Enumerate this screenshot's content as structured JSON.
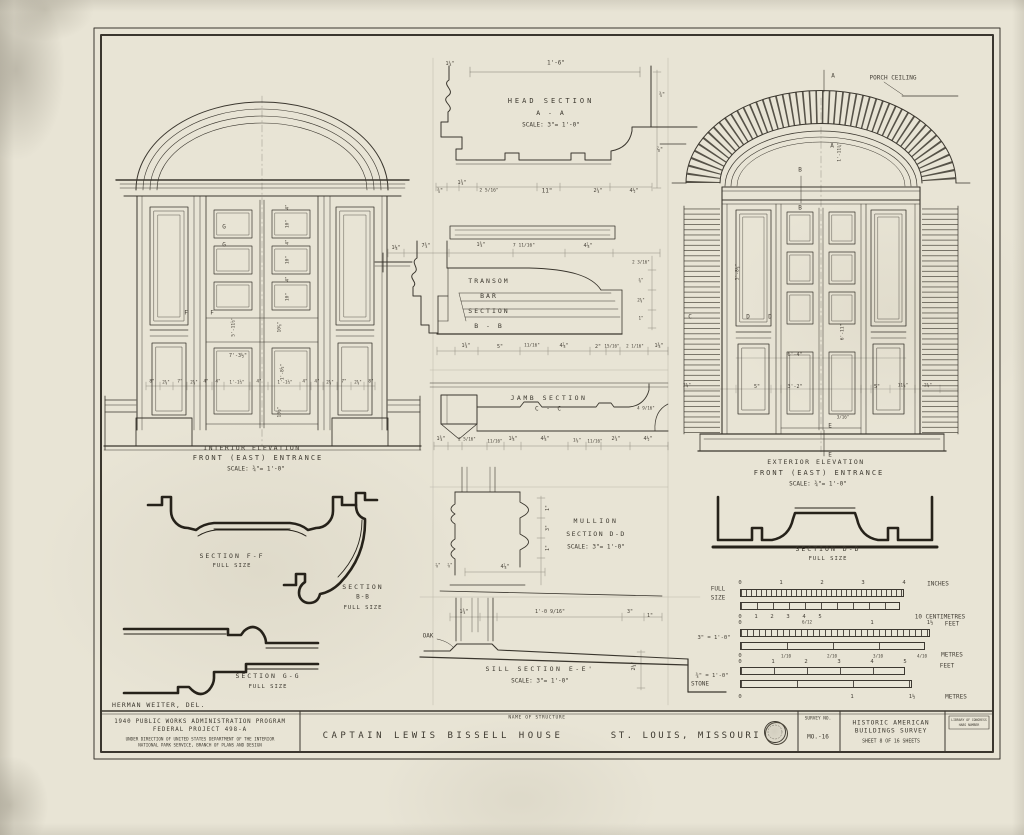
{
  "colors": {
    "paper": "#e8e4d5",
    "ink": "#3a362e",
    "heavy": "#26221a"
  },
  "titles": {
    "interior": {
      "l1": "INTERIOR ELEVATION",
      "l2": "FRONT (EAST) ENTRANCE",
      "scale": "SCALE:   ¾\"= 1'-0\""
    },
    "exterior": {
      "l1": "EXTERIOR ELEVATION",
      "l2": "FRONT (EAST) ENTRANCE",
      "scale": "SCALE:   ¾\"= 1'-0\""
    },
    "head": {
      "l1": "HEAD SECTION",
      "l2": "A - A",
      "scale": "SCALE:   3\"= 1'-0\""
    },
    "transom": {
      "l1": "TRANSOM",
      "l2": "BAR",
      "l3": "SECTION",
      "l4": "B - B"
    },
    "jamb": {
      "l1": "JAMB SECTION",
      "l2": "C - C"
    },
    "mullion": {
      "l1": "MULLION",
      "l2": "SECTION D-D",
      "scale": "SCALE: 3\"= 1'-0\""
    },
    "sill": {
      "l1": "SILL SECTION E-E'",
      "scale": "SCALE:  3\"= 1'-0\""
    },
    "ff": {
      "l1": "SECTION F-F",
      "l2": "FULL SIZE"
    },
    "bb": {
      "l1": "SECTION",
      "l2": "B-B",
      "l3": "FULL SIZE"
    },
    "gg": {
      "l1": "SECTION G-G",
      "l2": "FULL SIZE"
    },
    "dd": {
      "l1": "SECTION D-D",
      "l2": "FULL SIZE"
    },
    "delineator": "HERMAN WEITER, DEL."
  },
  "title_block": {
    "pwa1": "1940 PUBLIC WORKS ADMINISTRATION PROGRAM",
    "pwa2": "FEDERAL PROJECT 498-A",
    "pwa3": "UNDER DIRECTION OF UNITED STATES DEPARTMENT OF THE INTERIOR",
    "pwa4": "NATIONAL PARK SERVICE, BRANCH OF PLANS AND DESIGN",
    "name_label": "NAME OF STRUCTURE",
    "structure": "CAPTAIN LEWIS BISSELL HOUSE",
    "location": "ST. LOUIS, MISSOURI",
    "survey_label": "SURVEY NO.",
    "survey_no": "MO.-16",
    "habs1": "HISTORIC AMERICAN",
    "habs2": "BUILDINGS SURVEY",
    "habs3": "SHEET 8 OF 16 SHEETS",
    "loc1": "LIBRARY OF CONGRESS",
    "loc2": "HABS NUMBER"
  },
  "labels": [
    {
      "t": "1'-6\"",
      "x": 556,
      "y": 63
    },
    {
      "t": "1¼\"",
      "x": 450,
      "y": 64,
      "fs": 5
    },
    {
      "t": "¾\"",
      "x": 440,
      "y": 191,
      "fs": 5
    },
    {
      "t": "1¾\"",
      "x": 462,
      "y": 183,
      "fs": 5
    },
    {
      "t": "2 5/16\"",
      "x": 489,
      "y": 191,
      "fs": 4.6
    },
    {
      "t": "11\"",
      "x": 547,
      "y": 191
    },
    {
      "t": "2¼\"",
      "x": 598,
      "y": 191,
      "fs": 5
    },
    {
      "t": "4½\"",
      "x": 634,
      "y": 191,
      "fs": 5
    },
    {
      "t": "¾\"",
      "x": 662,
      "y": 95,
      "fs": 5
    },
    {
      "t": "⅞\"",
      "x": 660,
      "y": 150,
      "fs": 5
    },
    {
      "t": "1⅛\"",
      "x": 396,
      "y": 248,
      "fs": 5
    },
    {
      "t": "7¾\"",
      "x": 426,
      "y": 246,
      "fs": 5
    },
    {
      "t": "1¾\"",
      "x": 481,
      "y": 245,
      "fs": 5
    },
    {
      "t": "7 11/16\"",
      "x": 524,
      "y": 246,
      "fs": 4.6
    },
    {
      "t": "4⅞\"",
      "x": 588,
      "y": 246,
      "fs": 5
    },
    {
      "t": "1¾\"",
      "x": 466,
      "y": 346,
      "fs": 5
    },
    {
      "t": "5\"",
      "x": 500,
      "y": 347,
      "fs": 5
    },
    {
      "t": "11/16\"",
      "x": 532,
      "y": 346,
      "fs": 4.4
    },
    {
      "t": "4⅞\"",
      "x": 564,
      "y": 346,
      "fs": 5
    },
    {
      "t": "2\"",
      "x": 598,
      "y": 347,
      "fs": 5
    },
    {
      "t": "15/16\"",
      "x": 612,
      "y": 346,
      "fs": 4.2
    },
    {
      "t": "2 1/16\"",
      "x": 635,
      "y": 346,
      "fs": 4.2
    },
    {
      "t": "1⅜\"",
      "x": 659,
      "y": 346,
      "fs": 5
    },
    {
      "t": "2 3/16\"",
      "x": 641,
      "y": 262,
      "fs": 4.2
    },
    {
      "t": "⅜\"",
      "x": 641,
      "y": 280,
      "fs": 4.2
    },
    {
      "t": "2⅜\"",
      "x": 641,
      "y": 300,
      "fs": 4.2
    },
    {
      "t": "1\"",
      "x": 641,
      "y": 318,
      "fs": 4.2
    },
    {
      "t": "1¾\"",
      "x": 441,
      "y": 439,
      "fs": 5
    },
    {
      "t": "2 5/16\"",
      "x": 467,
      "y": 439,
      "fs": 4.2
    },
    {
      "t": "11/16\"",
      "x": 495,
      "y": 441,
      "fs": 4.2
    },
    {
      "t": "1⅛\"",
      "x": 513,
      "y": 439,
      "fs": 5
    },
    {
      "t": "4⅜\"",
      "x": 545,
      "y": 439,
      "fs": 5
    },
    {
      "t": "1⅛\"",
      "x": 577,
      "y": 441,
      "fs": 4.6
    },
    {
      "t": "11/16\"",
      "x": 595,
      "y": 441,
      "fs": 4.2
    },
    {
      "t": "2¼\"",
      "x": 616,
      "y": 439,
      "fs": 5
    },
    {
      "t": "4½\"",
      "x": 648,
      "y": 439,
      "fs": 5
    },
    {
      "t": "4 9/16\"",
      "x": 646,
      "y": 408,
      "fs": 4.2
    },
    {
      "t": "1\"",
      "x": 548,
      "y": 508,
      "r": -90,
      "fs": 5
    },
    {
      "t": "3\"",
      "x": 548,
      "y": 528,
      "r": -90,
      "fs": 5
    },
    {
      "t": "1\"",
      "x": 548,
      "y": 548,
      "r": -90,
      "fs": 5
    },
    {
      "t": "⅞\"",
      "x": 438,
      "y": 566,
      "fs": 4.4
    },
    {
      "t": "⅞\"",
      "x": 450,
      "y": 566,
      "fs": 4.4
    },
    {
      "t": "4⅞\"",
      "x": 505,
      "y": 567,
      "fs": 5
    },
    {
      "t": "1¾\"",
      "x": 464,
      "y": 612,
      "fs": 5
    },
    {
      "t": "1'-0 9/16\"",
      "x": 550,
      "y": 612,
      "fs": 5
    },
    {
      "t": "3\"",
      "x": 630,
      "y": 612,
      "fs": 5
    },
    {
      "t": "1\"",
      "x": 650,
      "y": 616,
      "fs": 5
    },
    {
      "t": "OAK",
      "x": 428,
      "y": 636,
      "fs": 6
    },
    {
      "t": "STONE",
      "x": 700,
      "y": 684,
      "fs": 6
    },
    {
      "t": "2¼\"",
      "x": 634,
      "y": 666,
      "r": -90,
      "fs": 5
    },
    {
      "t": "G",
      "x": 224,
      "y": 227,
      "fs": 6
    },
    {
      "t": "G",
      "x": 224,
      "y": 245,
      "fs": 6
    },
    {
      "t": "F",
      "x": 186,
      "y": 313,
      "fs": 6
    },
    {
      "t": "F",
      "x": 212,
      "y": 313,
      "fs": 6
    },
    {
      "t": "4\"",
      "x": 288,
      "y": 207,
      "r": -90,
      "fs": 4.6
    },
    {
      "t": "10\"",
      "x": 288,
      "y": 224,
      "r": -90,
      "fs": 4.6
    },
    {
      "t": "4\"",
      "x": 288,
      "y": 242,
      "r": -90,
      "fs": 4.6
    },
    {
      "t": "10\"",
      "x": 288,
      "y": 260,
      "r": -90,
      "fs": 4.6
    },
    {
      "t": "4\"",
      "x": 288,
      "y": 279,
      "r": -90,
      "fs": 4.6
    },
    {
      "t": "10\"",
      "x": 288,
      "y": 297,
      "r": -90,
      "fs": 4.6
    },
    {
      "t": "10⅞\"",
      "x": 280,
      "y": 327,
      "r": -90,
      "fs": 4.6
    },
    {
      "t": "5'-11½\"",
      "x": 234,
      "y": 327,
      "r": -90,
      "fs": 4.6
    },
    {
      "t": "7'-3½\"",
      "x": 238,
      "y": 356,
      "fs": 5
    },
    {
      "t": "1'-8½\"",
      "x": 283,
      "y": 372,
      "r": -90,
      "fs": 4.6
    },
    {
      "t": "10½\"",
      "x": 280,
      "y": 412,
      "r": -90,
      "fs": 4.6
    },
    {
      "t": "8\"",
      "x": 152,
      "y": 382,
      "fs": 4.4
    },
    {
      "t": "2⅝\"",
      "x": 166,
      "y": 382,
      "fs": 4.2
    },
    {
      "t": "7\"",
      "x": 180,
      "y": 382,
      "fs": 4.4
    },
    {
      "t": "2⅝\"",
      "x": 194,
      "y": 382,
      "fs": 4.2
    },
    {
      "t": "4\"",
      "x": 206,
      "y": 382,
      "fs": 4.4
    },
    {
      "t": "4\"",
      "x": 218,
      "y": 382,
      "fs": 4.4
    },
    {
      "t": "1'-1½\"",
      "x": 237,
      "y": 382,
      "fs": 4.2
    },
    {
      "t": "4\"",
      "x": 259,
      "y": 382,
      "fs": 4.4
    },
    {
      "t": "1'-1½\"",
      "x": 285,
      "y": 382,
      "fs": 4.2
    },
    {
      "t": "4\"",
      "x": 305,
      "y": 382,
      "fs": 4.4
    },
    {
      "t": "4\"",
      "x": 317,
      "y": 382,
      "fs": 4.4
    },
    {
      "t": "2⅝\"",
      "x": 330,
      "y": 382,
      "fs": 4.2
    },
    {
      "t": "7\"",
      "x": 344,
      "y": 382,
      "fs": 4.4
    },
    {
      "t": "2⅝\"",
      "x": 358,
      "y": 382,
      "fs": 4.2
    },
    {
      "t": "8\"",
      "x": 371,
      "y": 382,
      "fs": 4.4
    },
    {
      "t": "PORCH CEILING",
      "x": 893,
      "y": 78,
      "fs": 6,
      "n": "porch-ceiling-label"
    },
    {
      "t": "A",
      "x": 833,
      "y": 76,
      "fs": 6,
      "n": "section-marker-a"
    },
    {
      "t": "A",
      "x": 832,
      "y": 146,
      "fs": 6,
      "n": "section-marker-a"
    },
    {
      "t": "B",
      "x": 800,
      "y": 170,
      "fs": 6,
      "n": "section-marker-b"
    },
    {
      "t": "B",
      "x": 800,
      "y": 208,
      "fs": 6,
      "n": "section-marker-b"
    },
    {
      "t": "C",
      "x": 690,
      "y": 317,
      "fs": 6,
      "n": "section-marker-c"
    },
    {
      "t": "D",
      "x": 748,
      "y": 317,
      "fs": 6,
      "n": "section-marker-d"
    },
    {
      "t": "D",
      "x": 770,
      "y": 317,
      "fs": 6,
      "n": "section-marker-d"
    },
    {
      "t": "E",
      "x": 830,
      "y": 426,
      "fs": 6,
      "n": "section-marker-e"
    },
    {
      "t": "E",
      "x": 830,
      "y": 455,
      "fs": 6,
      "n": "section-marker-e"
    },
    {
      "t": "1'-11¾\"",
      "x": 840,
      "y": 152,
      "r": -90,
      "fs": 4.6
    },
    {
      "t": "5'-8⅛\"",
      "x": 738,
      "y": 272,
      "r": -90,
      "fs": 4.6
    },
    {
      "t": "6'-11\"",
      "x": 843,
      "y": 332,
      "r": -90,
      "fs": 4.6
    },
    {
      "t": "6'-4\"",
      "x": 795,
      "y": 355,
      "fs": 5
    },
    {
      "t": "3'-2\"",
      "x": 795,
      "y": 387,
      "fs": 5
    },
    {
      "t": "5\"",
      "x": 757,
      "y": 387,
      "fs": 5
    },
    {
      "t": "5\"",
      "x": 877,
      "y": 387,
      "fs": 5
    },
    {
      "t": "11¼\"",
      "x": 903,
      "y": 386,
      "fs": 4.4
    },
    {
      "t": "2¾\"",
      "x": 687,
      "y": 386,
      "fs": 4.4
    },
    {
      "t": "2¾\"",
      "x": 928,
      "y": 386,
      "fs": 4.4
    },
    {
      "t": "3/16\"",
      "x": 843,
      "y": 417,
      "fs": 4.2
    },
    {
      "t": "FULL",
      "x": 718,
      "y": 589,
      "fs": 6,
      "n": "scale-bar-label"
    },
    {
      "t": "SIZE",
      "x": 718,
      "y": 598,
      "fs": 6,
      "n": "scale-bar-label"
    },
    {
      "t": "0",
      "x": 740,
      "y": 583,
      "fs": 5.5
    },
    {
      "t": "1",
      "x": 781,
      "y": 583,
      "fs": 5.5
    },
    {
      "t": "2",
      "x": 822,
      "y": 583,
      "fs": 5.5
    },
    {
      "t": "3",
      "x": 863,
      "y": 583,
      "fs": 5.5
    },
    {
      "t": "4",
      "x": 904,
      "y": 583,
      "fs": 5.5
    },
    {
      "t": "INCHES",
      "x": 938,
      "y": 584,
      "fs": 6,
      "n": "scale-bar-unit"
    },
    {
      "t": "0",
      "x": 740,
      "y": 617,
      "fs": 5.5
    },
    {
      "t": "1",
      "x": 756,
      "y": 617,
      "fs": 5.5
    },
    {
      "t": "2",
      "x": 772,
      "y": 617,
      "fs": 5.5
    },
    {
      "t": "3",
      "x": 788,
      "y": 617,
      "fs": 5.5
    },
    {
      "t": "4",
      "x": 804,
      "y": 617,
      "fs": 5.5
    },
    {
      "t": "5",
      "x": 820,
      "y": 617,
      "fs": 5.5
    },
    {
      "t": "10 CENTIMETRES",
      "x": 940,
      "y": 617,
      "fs": 6,
      "n": "scale-bar-unit"
    },
    {
      "t": "3\" = 1'-0\"",
      "x": 714,
      "y": 638,
      "fs": 5.5,
      "n": "scale-bar-label"
    },
    {
      "t": "0",
      "x": 740,
      "y": 623,
      "fs": 5.5
    },
    {
      "t": "6/12",
      "x": 807,
      "y": 622,
      "fs": 4.2
    },
    {
      "t": "1",
      "x": 872,
      "y": 623,
      "fs": 5.5
    },
    {
      "t": "1½",
      "x": 930,
      "y": 623,
      "fs": 5.5
    },
    {
      "t": "FEET",
      "x": 952,
      "y": 624,
      "fs": 6,
      "n": "scale-bar-unit"
    },
    {
      "t": "0",
      "x": 740,
      "y": 656,
      "fs": 5.5
    },
    {
      "t": "1/10",
      "x": 786,
      "y": 656,
      "fs": 4.2
    },
    {
      "t": "2/10",
      "x": 832,
      "y": 656,
      "fs": 4.2
    },
    {
      "t": "3/10",
      "x": 878,
      "y": 656,
      "fs": 4.2
    },
    {
      "t": "4/10",
      "x": 922,
      "y": 656,
      "fs": 4.2
    },
    {
      "t": "METRES",
      "x": 952,
      "y": 655,
      "fs": 6,
      "n": "scale-bar-unit"
    },
    {
      "t": "¾\" = 1'-0\"",
      "x": 712,
      "y": 676,
      "fs": 5.5,
      "n": "scale-bar-label"
    },
    {
      "t": "0",
      "x": 740,
      "y": 662,
      "fs": 5.5
    },
    {
      "t": "1",
      "x": 773,
      "y": 662,
      "fs": 5.5
    },
    {
      "t": "2",
      "x": 806,
      "y": 662,
      "fs": 5.5
    },
    {
      "t": "3",
      "x": 839,
      "y": 662,
      "fs": 5.5
    },
    {
      "t": "4",
      "x": 872,
      "y": 662,
      "fs": 5.5
    },
    {
      "t": "5",
      "x": 905,
      "y": 662,
      "fs": 5.5
    },
    {
      "t": "FEET",
      "x": 947,
      "y": 666,
      "fs": 6,
      "n": "scale-bar-unit"
    },
    {
      "t": "0",
      "x": 740,
      "y": 697,
      "fs": 5.5
    },
    {
      "t": "1",
      "x": 852,
      "y": 697,
      "fs": 5.5
    },
    {
      "t": "1½",
      "x": 912,
      "y": 697,
      "fs": 5.5
    },
    {
      "t": "METRES",
      "x": 956,
      "y": 697,
      "fs": 6,
      "n": "scale-bar-unit"
    }
  ]
}
